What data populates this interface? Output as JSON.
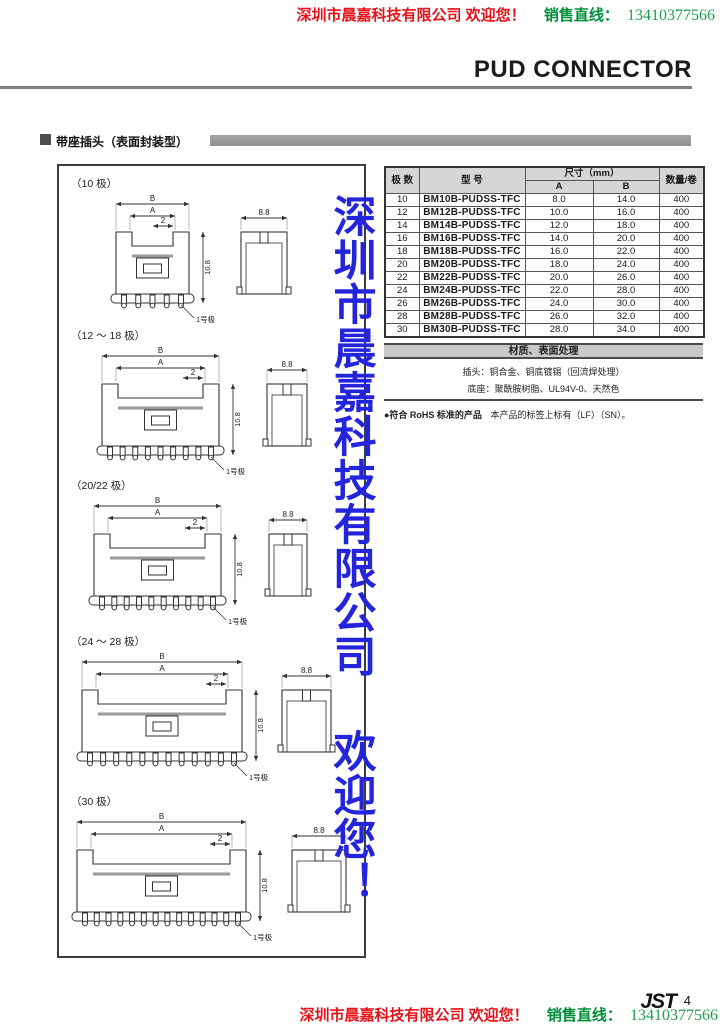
{
  "colors": {
    "red": "#e8111a",
    "green": "#008f39",
    "green_light": "#1fa04a",
    "blue_watermark": "#2424dd"
  },
  "header": {
    "company_line": "深圳市晨嘉科技有限公司 欢迎您！",
    "sales_label": "销售直线：",
    "phone": "13410377566",
    "page_title": "PUD CONNECTOR"
  },
  "section": {
    "title": "带座插头（表面封装型）"
  },
  "watermark": {
    "text": "深圳市晨嘉科技有限公司 欢迎您！"
  },
  "drawings": {
    "groups": [
      {
        "label": "（10 极）",
        "pins": 5
      },
      {
        "label": "（12 ～ 18 极）",
        "pins": 9
      },
      {
        "label": "（20/22 极）",
        "pins": 10
      },
      {
        "label": "（24 ～ 28 极）",
        "pins": 12
      },
      {
        "label": "（30 极）",
        "pins": 14
      }
    ],
    "dim_labels": {
      "b": "B",
      "a": "A",
      "two": "2",
      "height": "10.8",
      "side": "8.8",
      "pin1": "1号极"
    }
  },
  "table": {
    "col_pins": "极 数",
    "col_model": "型 号",
    "col_dim": "尺寸（mm）",
    "col_a": "A",
    "col_b": "B",
    "col_qty": "数量/卷",
    "rows": [
      [
        "10",
        "BM10B-PUDSS-TFC",
        "8.0",
        "14.0",
        "400"
      ],
      [
        "12",
        "BM12B-PUDSS-TFC",
        "10.0",
        "16.0",
        "400"
      ],
      [
        "14",
        "BM14B-PUDSS-TFC",
        "12.0",
        "18.0",
        "400"
      ],
      [
        "16",
        "BM16B-PUDSS-TFC",
        "14.0",
        "20.0",
        "400"
      ],
      [
        "18",
        "BM18B-PUDSS-TFC",
        "16.0",
        "22.0",
        "400"
      ],
      [
        "20",
        "BM20B-PUDSS-TFC",
        "18.0",
        "24.0",
        "400"
      ],
      [
        "22",
        "BM22B-PUDSS-TFC",
        "20.0",
        "26.0",
        "400"
      ],
      [
        "24",
        "BM24B-PUDSS-TFC",
        "22.0",
        "28.0",
        "400"
      ],
      [
        "26",
        "BM26B-PUDSS-TFC",
        "24.0",
        "30.0",
        "400"
      ],
      [
        "28",
        "BM28B-PUDSS-TFC",
        "26.0",
        "32.0",
        "400"
      ],
      [
        "30",
        "BM30B-PUDSS-TFC",
        "28.0",
        "34.0",
        "400"
      ]
    ]
  },
  "material": {
    "header": "材质、表面处理",
    "line1": "插头：铜合金、铜底镀锡（回流焊处理）",
    "line2": "底座：聚酰胺树脂、UL94V-0、天然色",
    "rohs_bold": "●符合 RoHS 标准的产品",
    "rohs_rest": "本产品的标签上标有（LF）（SN）。"
  },
  "footer": {
    "logo": "JST",
    "page": "4",
    "company_line": "深圳市晨嘉科技有限公司 欢迎您！",
    "sales_label": "销售直线：",
    "phone": "13410377566"
  }
}
